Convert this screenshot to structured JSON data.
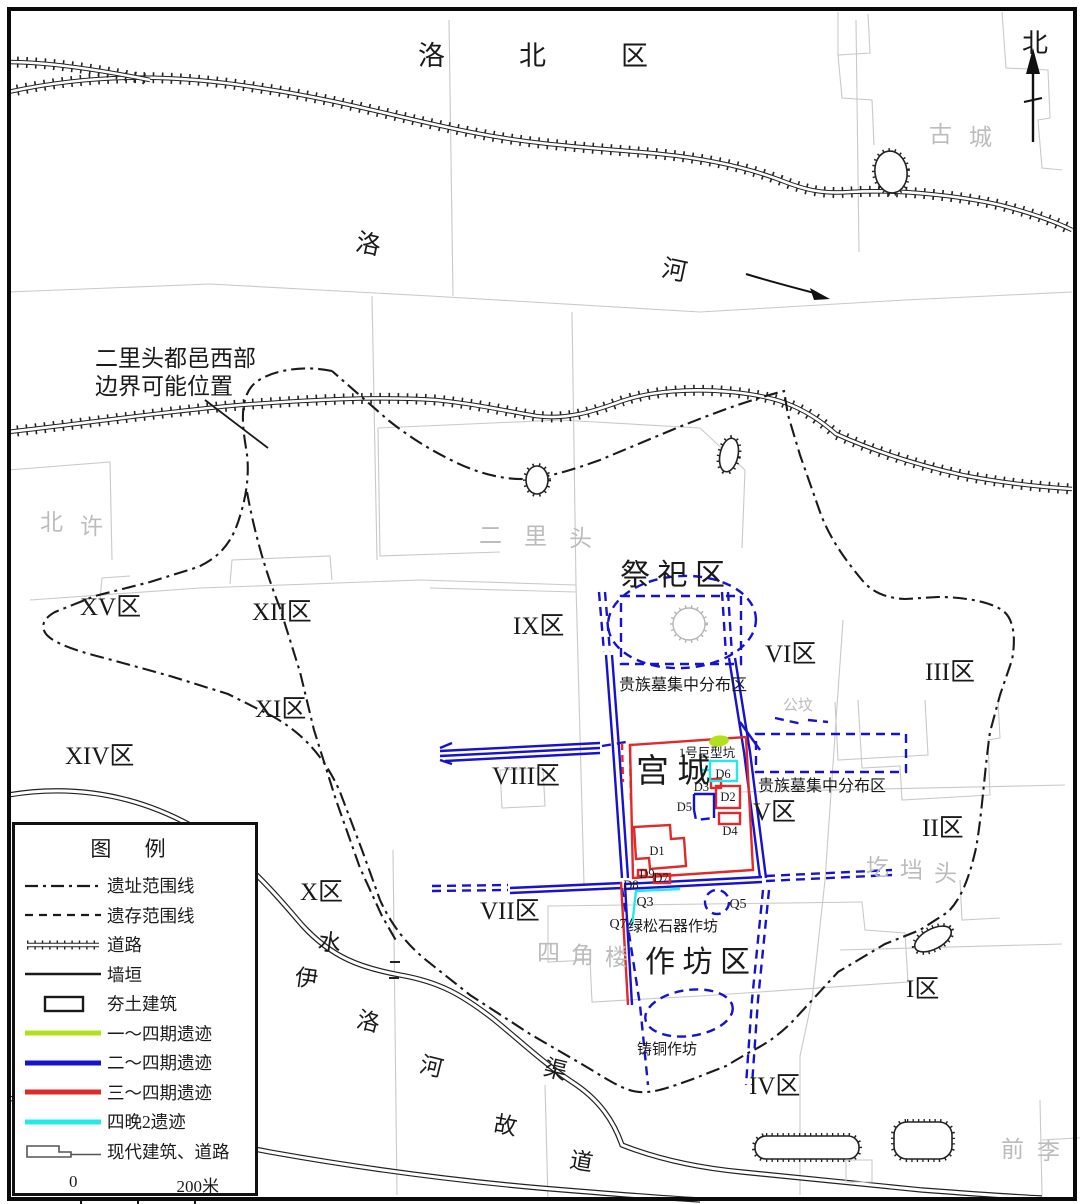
{
  "compass": {
    "north": "北"
  },
  "annotation": {
    "line1": "二里头都邑西部",
    "line2": "边界可能位置"
  },
  "rivers": {
    "luohe": [
      "洛",
      "河"
    ],
    "channel": [
      "伊",
      "水",
      "洛",
      "河",
      "渠",
      "故",
      "道"
    ]
  },
  "districts": {
    "luobei": [
      "洛",
      "北",
      "区"
    ],
    "xv": "XV区",
    "xii": "XII区",
    "xi": "XI区",
    "xiv": "XIV区",
    "x": "X区",
    "ix": "IX区",
    "viii": "VIII区",
    "vii": "VII区",
    "vi": "VI区",
    "v": "V区",
    "iv": "IV区",
    "iii": "III区",
    "ii": "II区",
    "i": "I区"
  },
  "zones": {
    "jisi": "祭 祀 区",
    "gongcheng": "宫 城",
    "zuofang": "作 坊 区"
  },
  "villages": {
    "gucheng": [
      "古",
      "城"
    ],
    "beixu": [
      "北",
      "许"
    ],
    "erlitou": [
      "二",
      "里",
      "头"
    ],
    "gongfen": "公坟",
    "gedangtou": [
      "圪",
      "垱",
      "头"
    ],
    "sijiaolou": [
      "四",
      "角",
      "楼"
    ],
    "qianli": [
      "前",
      "李"
    ]
  },
  "features": {
    "noble_tombs_north": "贵族墓集中分布区",
    "noble_tombs_east": "贵族墓集中分布区",
    "turquoise_workshop": "绿松石器作坊",
    "bronze_workshop": "铸铜作坊",
    "giant_pit": "1号巨型坑"
  },
  "sites": {
    "d1": "D1",
    "d2": "D2",
    "d3": "D3",
    "d4": "D4",
    "d5": "D5",
    "d6": "D6",
    "d7": "D7",
    "d8": "D8",
    "d9": "D9",
    "q3": "Q3",
    "q5": "Q5",
    "q7": "Q7"
  },
  "legend": {
    "title": "图 例",
    "items": [
      {
        "key": "site-boundary",
        "label": "遗址范围线"
      },
      {
        "key": "remains-boundary",
        "label": "遗存范围线"
      },
      {
        "key": "road",
        "label": "道路"
      },
      {
        "key": "wall",
        "label": "墙垣"
      },
      {
        "key": "rammed-earth",
        "label": "夯土建筑"
      },
      {
        "key": "phase1-4",
        "label": "一～四期遗迹"
      },
      {
        "key": "phase2-4",
        "label": "二～四期遗迹"
      },
      {
        "key": "phase3-4",
        "label": "三～四期遗迹"
      },
      {
        "key": "phase4-late2",
        "label": "四晚2遗迹"
      },
      {
        "key": "modern",
        "label": "现代建筑、道路"
      }
    ],
    "scale_zero": "0",
    "scale_end": "200米"
  },
  "colors": {
    "phase1_4": "#b2e11c",
    "phase2_4": "#1612cd",
    "phase3_4": "#e02a2a",
    "phase4_late2": "#25e8e8",
    "ink": "#1a1a1a",
    "parcel_gray": "#c9c9c9"
  }
}
